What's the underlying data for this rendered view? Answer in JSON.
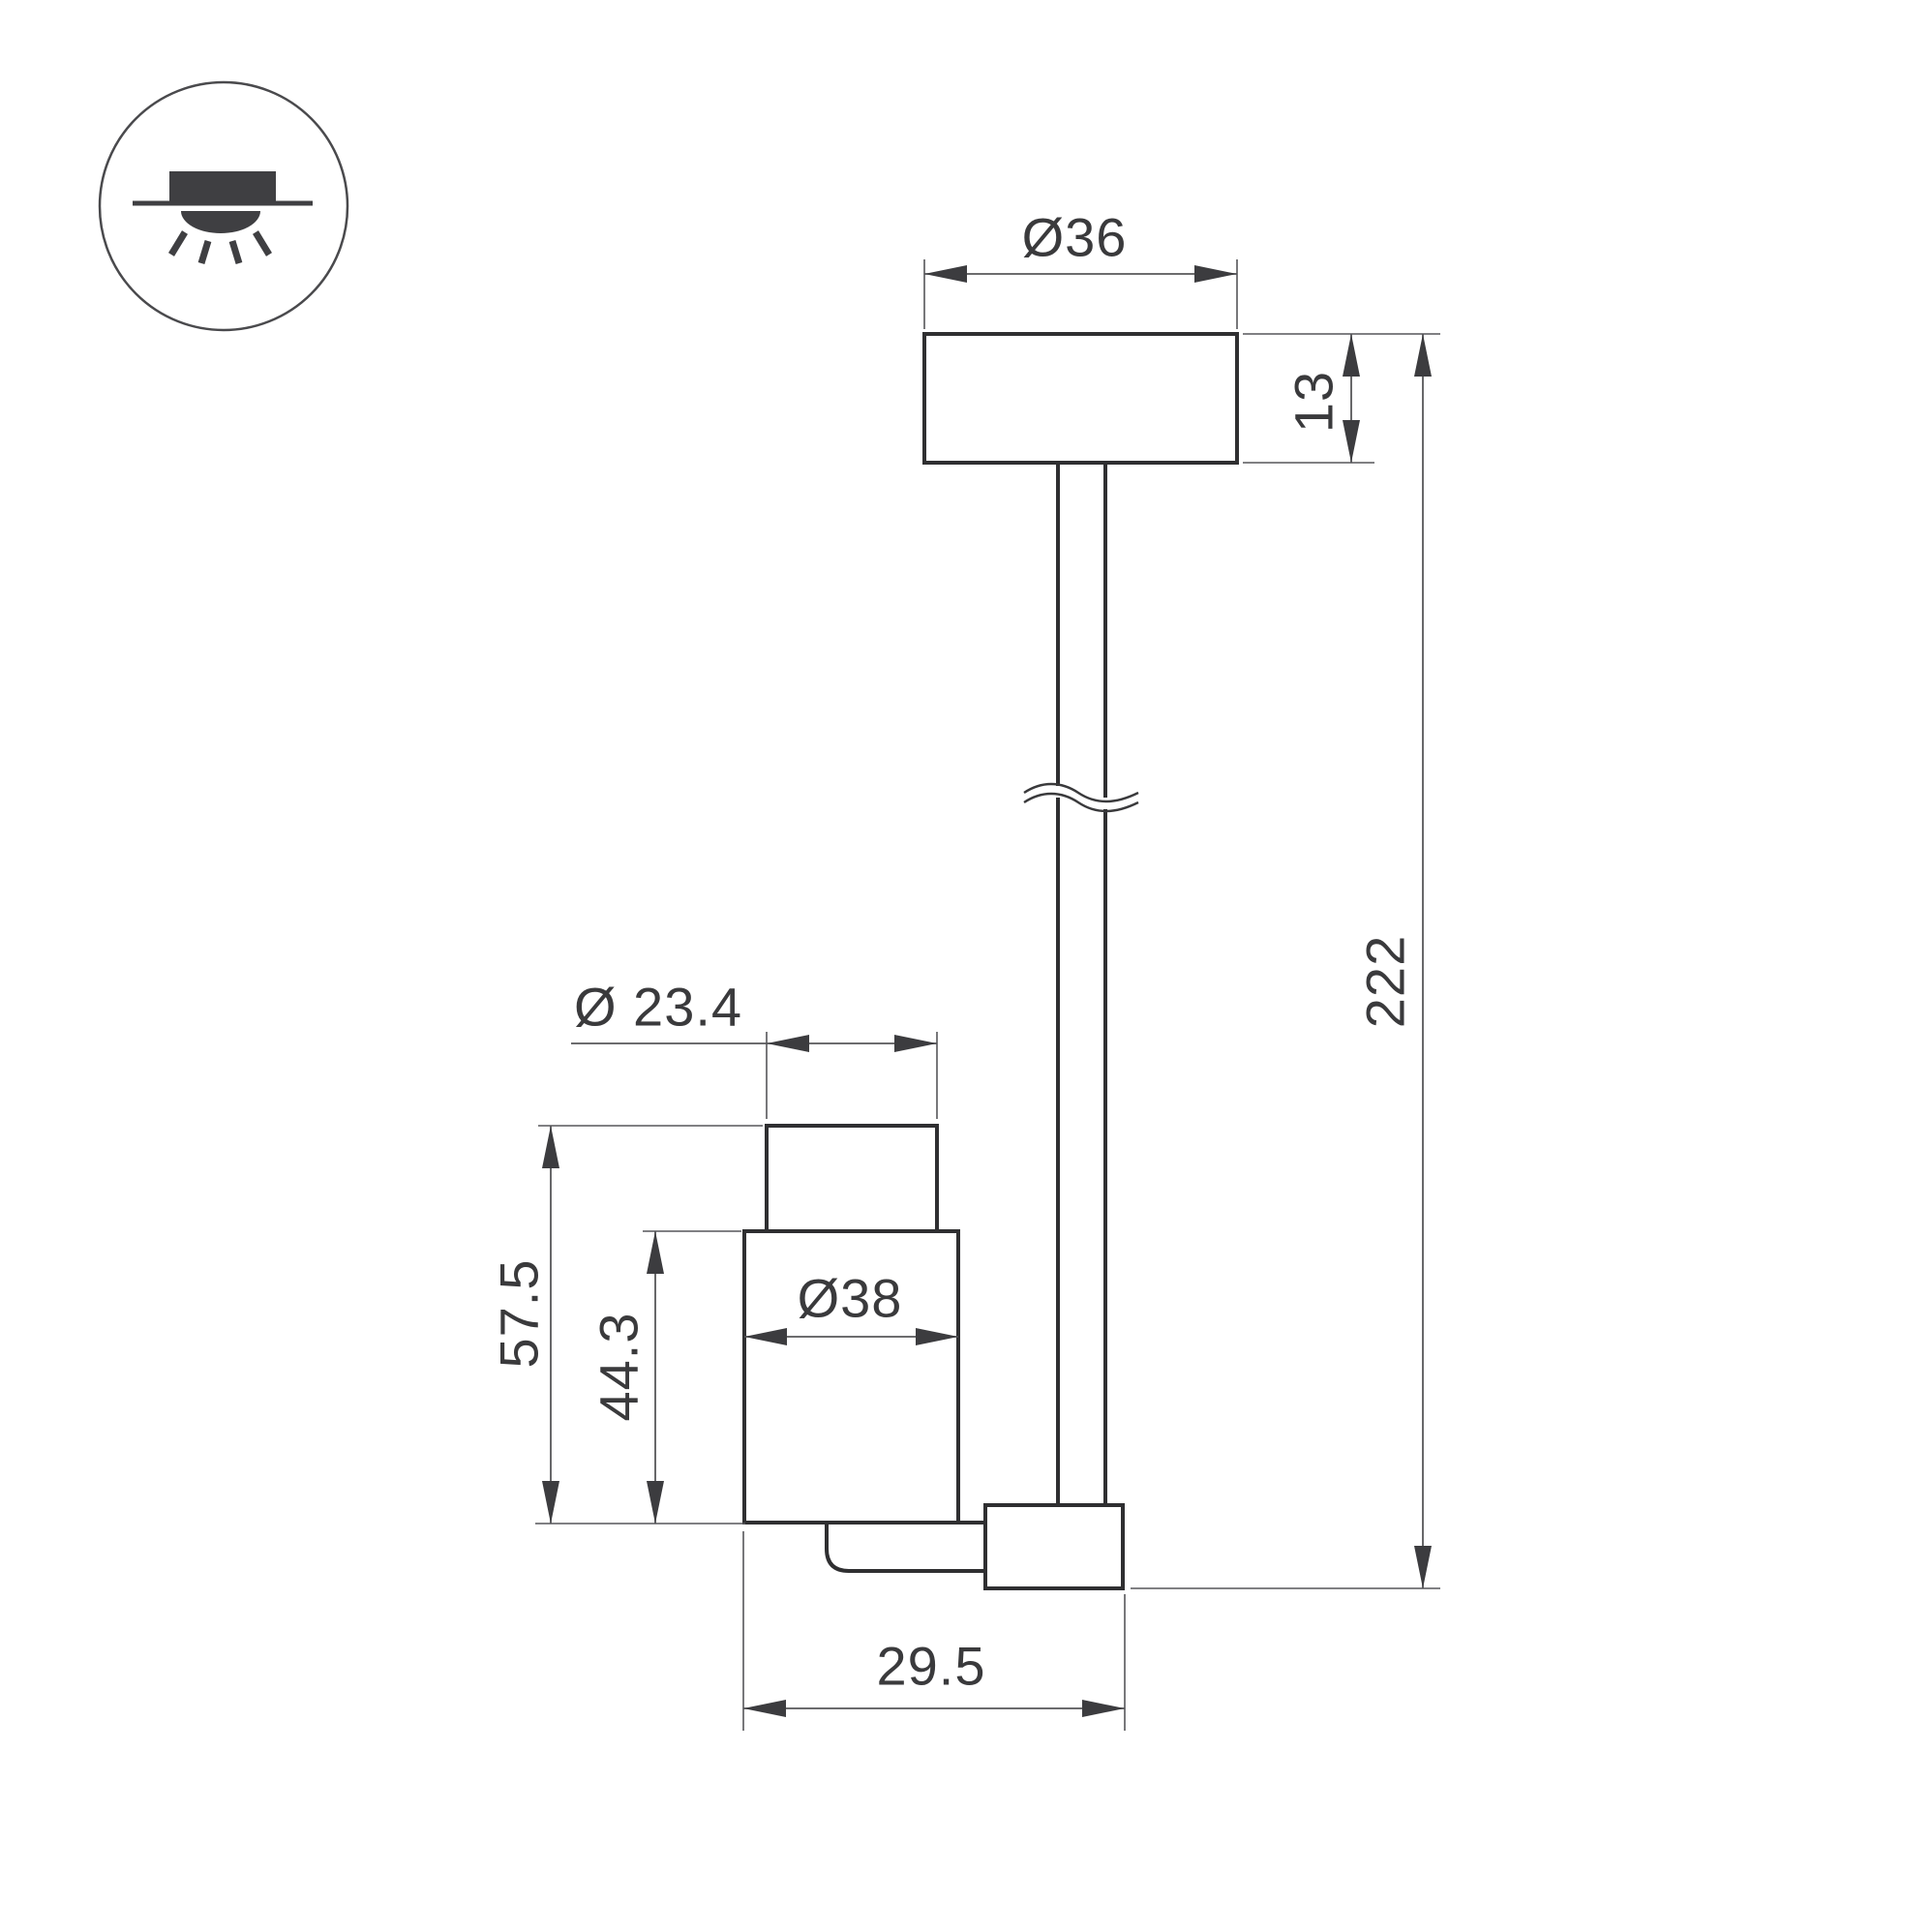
{
  "colors": {
    "background": "#ffffff",
    "outline": "#2f2f31",
    "dimension_line": "#57575a",
    "arrow": "#3c3c3f",
    "text": "#3a3a3c",
    "icon": "#3f3f42"
  },
  "icon": {
    "name": "recessed-downlight-icon"
  },
  "dimensions": {
    "canopy_diameter": "Ø36",
    "canopy_height": "13",
    "overall_height": "222",
    "head_top_diameter": "Ø 23.4",
    "head_body_diameter": "Ø38",
    "head_height": "57.5",
    "head_body_height": "44.3",
    "foot_width": "29.5"
  }
}
